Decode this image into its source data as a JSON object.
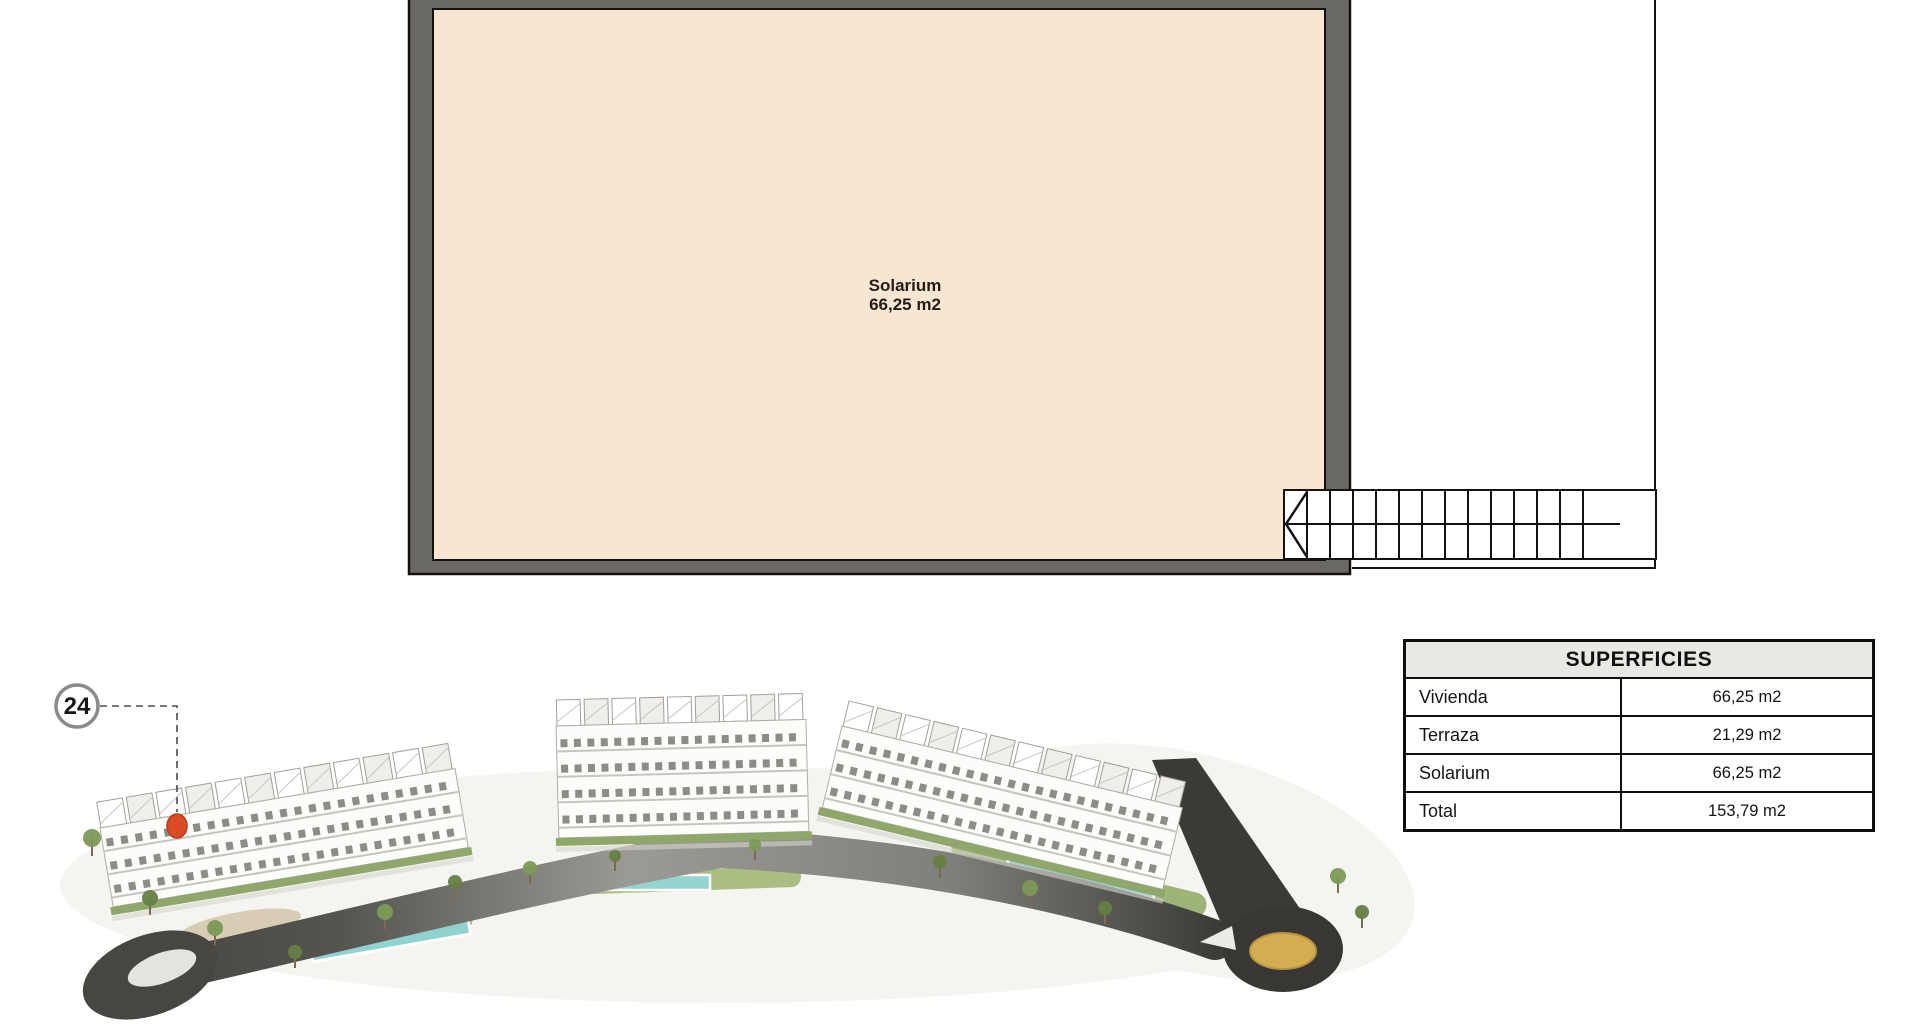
{
  "plan": {
    "room_label_line1": "Solarium",
    "room_label_line2": "66,25 m2",
    "floor_fill_color": "#f8e5d2",
    "wall_color": "#6a6865",
    "line_color": "#14110e"
  },
  "marker": {
    "number": "24"
  },
  "table": {
    "title": "SUPERFICIES",
    "header_bg": "#e9e8e5",
    "rows": [
      {
        "label": "Vivienda",
        "value": "66,25 m2"
      },
      {
        "label": "Terraza",
        "value": "21,29 m2"
      },
      {
        "label": "Solarium",
        "value": "66,25 m2"
      },
      {
        "label": "Total",
        "value": "153,79 m2"
      }
    ]
  },
  "illustration": {
    "road_color": "#45443f",
    "roundabout_center_color": "#d4ad52",
    "pool_color": "#8fd2cf",
    "lawn_color": "#a6ba80",
    "building_color": "#fcfcfa",
    "unit_marker_color": "#dd4a26"
  }
}
